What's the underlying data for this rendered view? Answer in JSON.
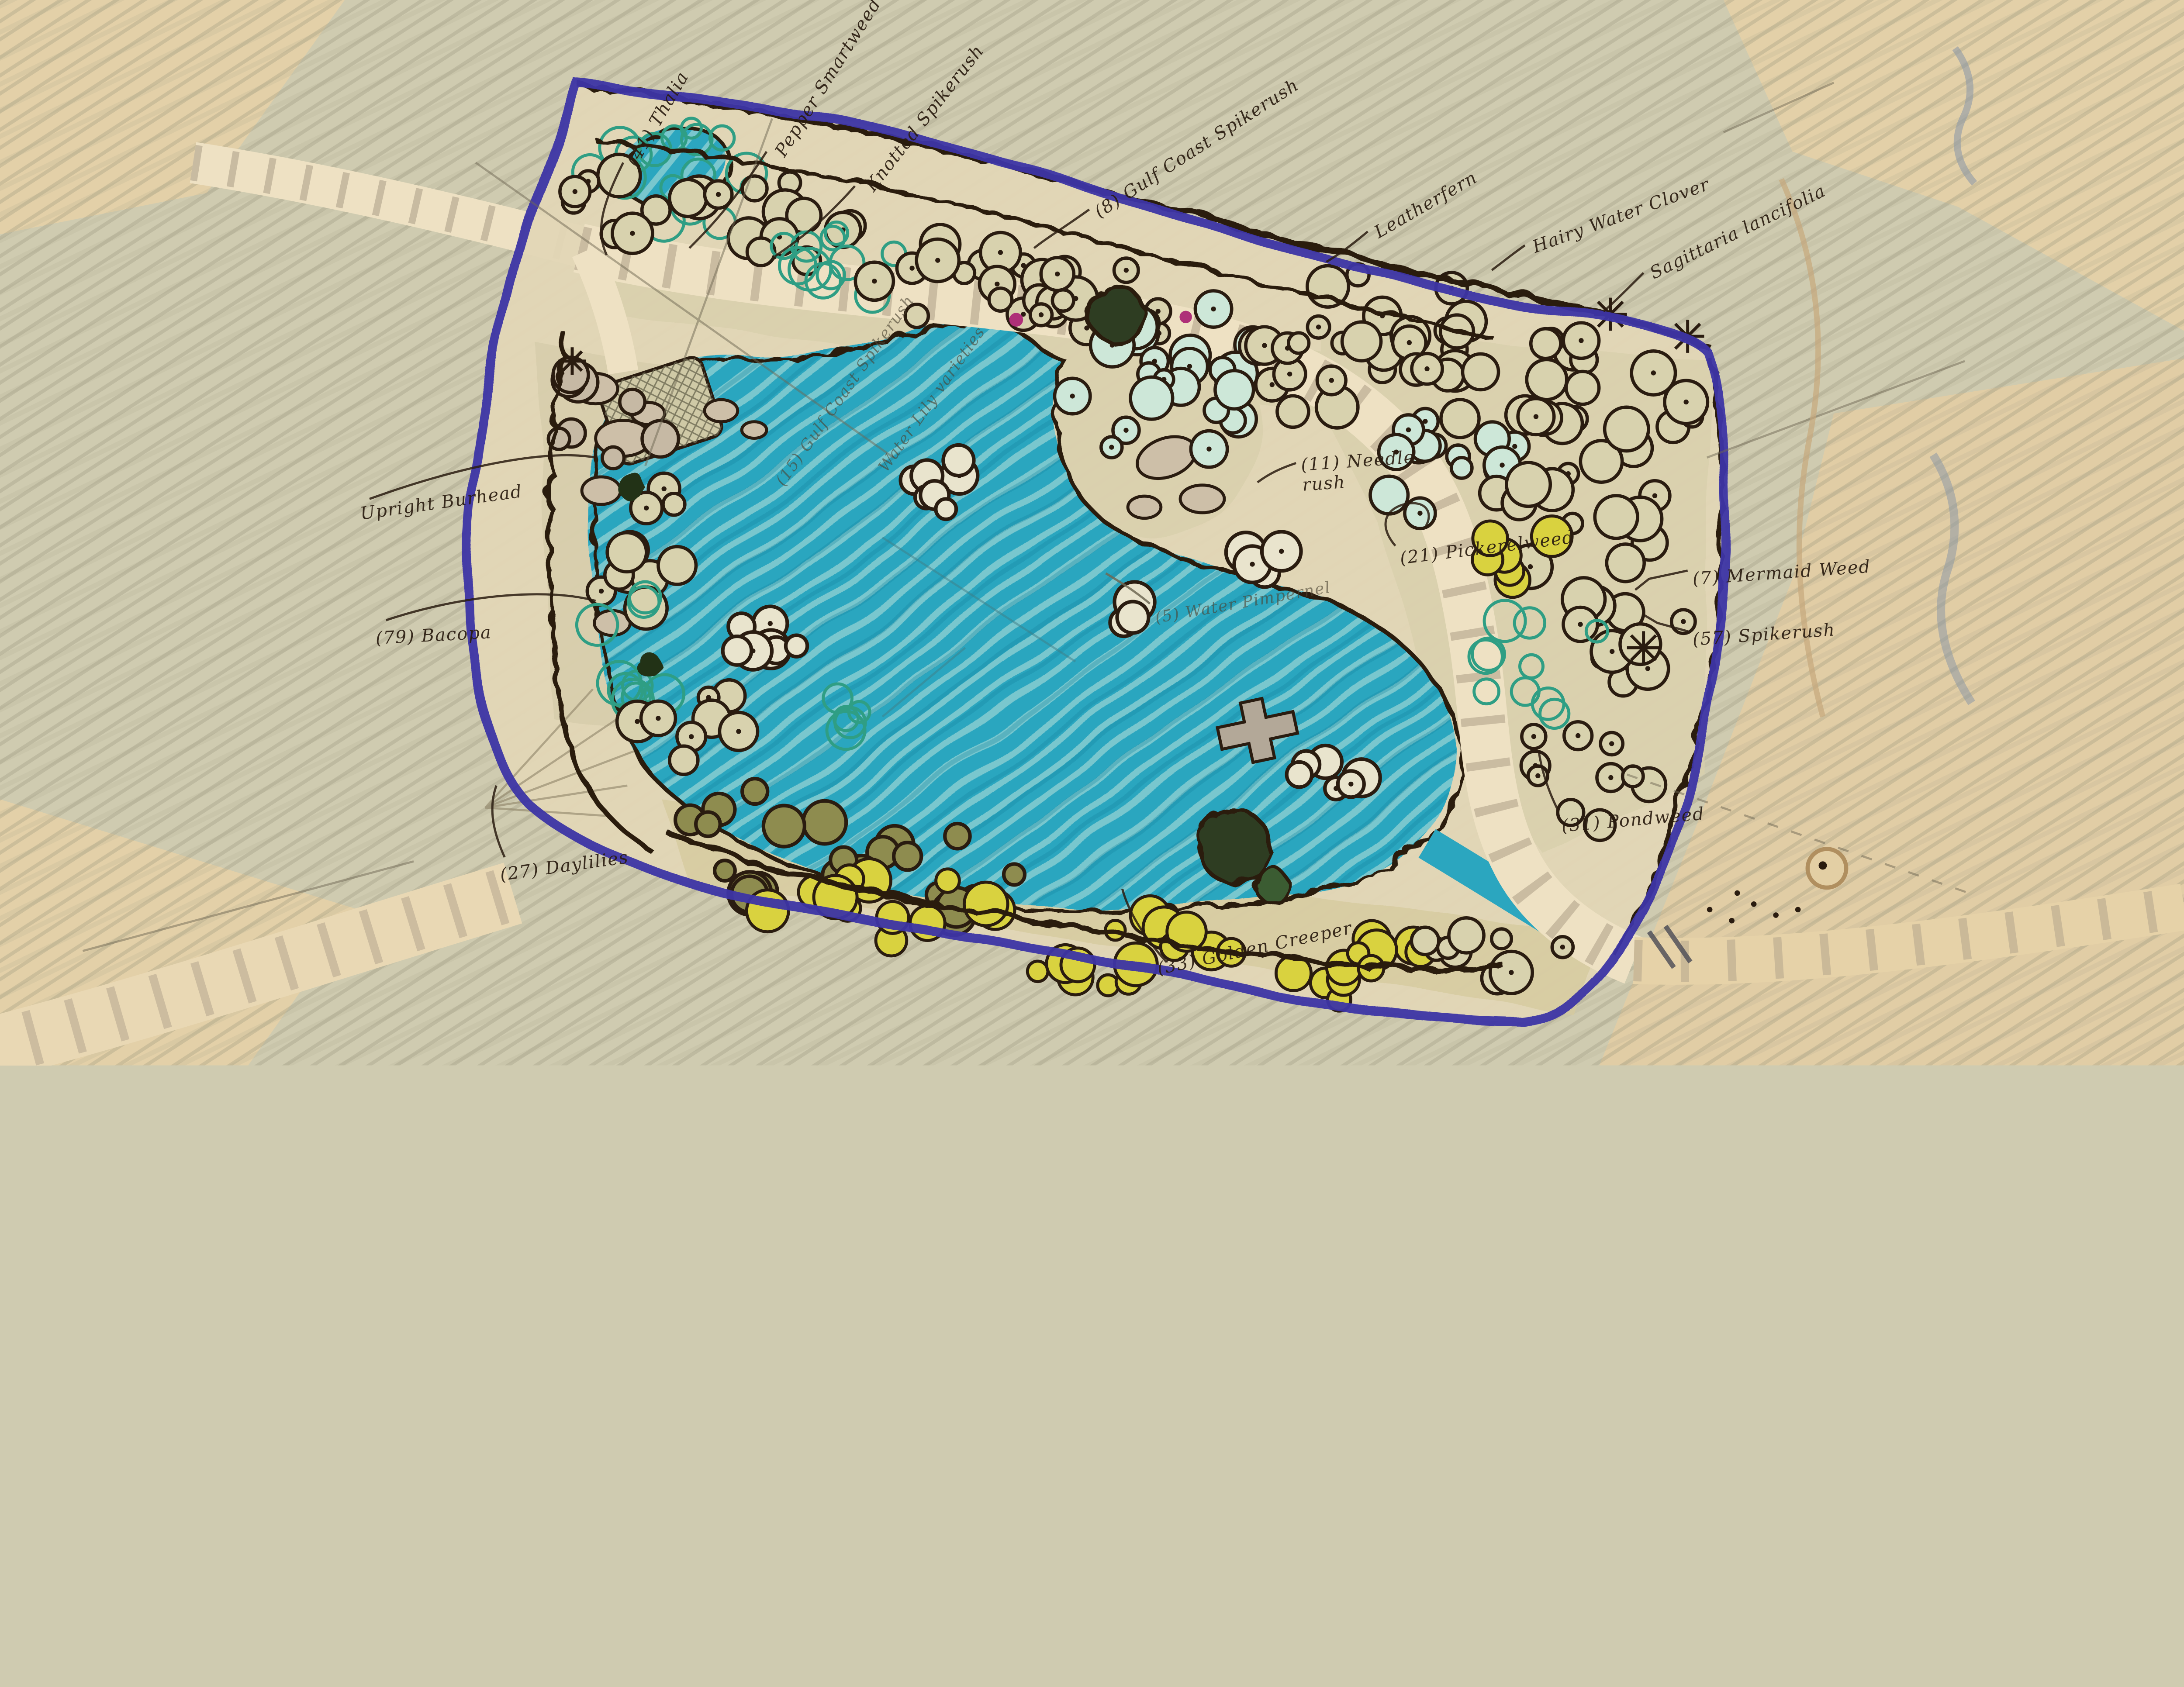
{
  "plan": {
    "kind": "hand-drawn wetland planting plan",
    "annotations": [
      {
        "id": "thalia",
        "label": "(41) Thalia",
        "x": 28.9,
        "y": 14.5,
        "rot": -60,
        "style": "ink"
      },
      {
        "id": "pepper-smartweed",
        "label": "Pepper Smartweed",
        "x": 35.7,
        "y": 13.6,
        "rot": -58,
        "style": "ink"
      },
      {
        "id": "knotted-spikerush",
        "label": "Knotted Spikerush",
        "x": 39.8,
        "y": 16.8,
        "rot": -52,
        "style": "ink"
      },
      {
        "id": "gulf-coast-spikerush",
        "label": "(8) Gulf Coast Spikerush",
        "x": 50.2,
        "y": 19.1,
        "rot": -33,
        "style": "ink"
      },
      {
        "id": "leatherfern",
        "label": "Leatherfern",
        "x": 63.0,
        "y": 21.0,
        "rot": -30,
        "style": "ink"
      },
      {
        "id": "hairy-water-clover",
        "label": "Hairy Water Clover",
        "x": 70.2,
        "y": 22.3,
        "rot": -20,
        "style": "ink"
      },
      {
        "id": "sagittaria-lancifolia",
        "label": "Sagittaria lancifolia",
        "x": 75.6,
        "y": 24.8,
        "rot": -26,
        "style": "ink"
      },
      {
        "id": "upright-burhead",
        "label": "Upright Burhead",
        "x": 16.5,
        "y": 47.3,
        "rot": -8,
        "style": "ink"
      },
      {
        "id": "bacopa",
        "label": "(79) Bacopa",
        "x": 17.2,
        "y": 59.0,
        "rot": -3,
        "style": "ink"
      },
      {
        "id": "needle-rush",
        "label": "(11) Needle\nrush",
        "x": 59.6,
        "y": 42.7,
        "rot": -4,
        "style": "ink"
      },
      {
        "id": "pickerelweed",
        "label": "(21) Pickerelweed",
        "x": 64.1,
        "y": 51.5,
        "rot": -7,
        "style": "ink"
      },
      {
        "id": "mermaid-weed",
        "label": "(7) Mermaid Weed",
        "x": 77.5,
        "y": 53.4,
        "rot": -4,
        "style": "ink"
      },
      {
        "id": "spikerush-57",
        "label": "(57) Spikerush",
        "x": 77.5,
        "y": 59.1,
        "rot": -4,
        "style": "ink"
      },
      {
        "id": "pondweed-31",
        "label": "(31) Pondweed",
        "x": 71.5,
        "y": 76.6,
        "rot": -5,
        "style": "ink"
      },
      {
        "id": "daylilies-27",
        "label": "(27) Daylilies",
        "x": 22.9,
        "y": 81.2,
        "rot": -8,
        "style": "ink"
      },
      {
        "id": "golden-creeper",
        "label": "(33) Golden Creeper",
        "x": 53.0,
        "y": 90.0,
        "rot": -12,
        "style": "ink"
      },
      {
        "id": "water-pimpernel",
        "label": "(5) Water Pimpernel",
        "x": 52.9,
        "y": 57.2,
        "rot": -10,
        "style": "pencil"
      },
      {
        "id": "pond-note-spikerush",
        "label": "(15) Gulf Coast Spikerush",
        "x": 35.7,
        "y": 44.6,
        "rot": -55,
        "style": "pencil"
      },
      {
        "id": "pond-note-waterlily",
        "label": "Water Lily varieties",
        "x": 40.4,
        "y": 43.3,
        "rot": -55,
        "style": "pencil"
      }
    ],
    "palette": {
      "paper": "#cfcbb0",
      "pond": "#2ba6bf",
      "boundary": "#3c35a6",
      "ink": "#2a1c10",
      "path_cream": "#eee1c3",
      "peach": "#ead1a6",
      "sage": "#d8d2ae",
      "teal_veg": "#2f9e84",
      "olive_hedge": "#8e8c4f",
      "yellow_flower": "#d9d23f",
      "dark_tree": "#2e3d22",
      "magenta_accent": "#ae2f78"
    }
  }
}
